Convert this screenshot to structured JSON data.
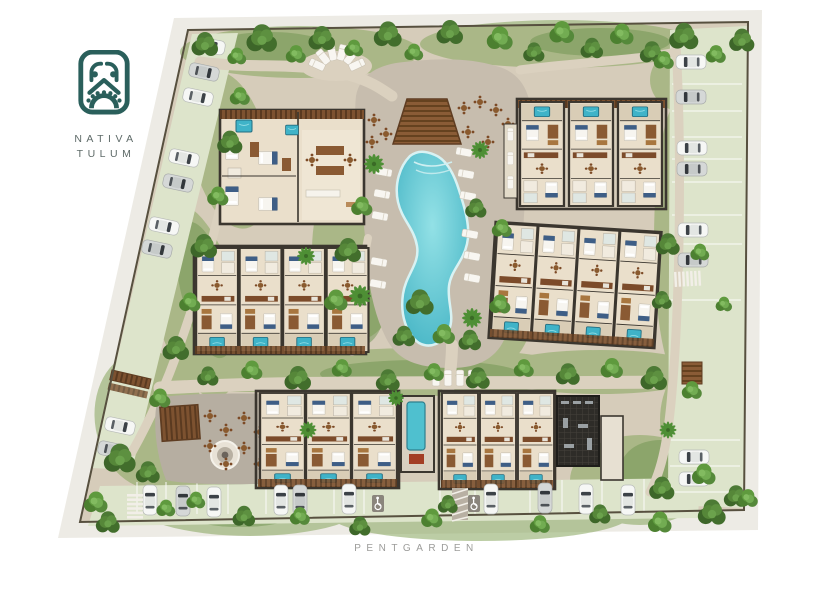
{
  "branding": {
    "logo_icon": "mayan-glyph-logo",
    "name_line1": "NATIVA",
    "name_line2": "TULUM"
  },
  "footer": {
    "project_name": "PENTGARDEN"
  },
  "site_plan": {
    "view": "top-down-masterplan-rendering",
    "amenities": [
      "main-pool",
      "pool-deck-palapa",
      "sun-loungers",
      "restaurant-plaza",
      "round-fountain",
      "lap-pool-courtyard",
      "gym-building",
      "gardens",
      "perimeter-parking",
      "accessible-parking",
      "crosswalks",
      "entrance-gates"
    ],
    "residential_buildings": 6
  },
  "colors": {
    "logo_teal": "#2a5f5b",
    "brand_text": "#5e6a68",
    "footer_text": "#9c9c9a",
    "canvas": "#ffffff",
    "sidewalk": "#edebe5",
    "lawn": "#dde4cb",
    "sand": "#dbd1bf",
    "site_base": "#d6ccba",
    "paver": "#c7bdae",
    "plaza_gray": "#b6aea1",
    "pool_water": "#58c5d0",
    "pool_edge": "#d8f2f3",
    "plunge_pool": "#3fb3c8",
    "wall": "#3b362f",
    "floor": "#eadfcb",
    "wood": "#7d5230",
    "tree_dark": "#3d6629",
    "tree_mid": "#4c7a35",
    "tree_light": "#6ba24c",
    "car_white": "#f6f7f5",
    "car_silver": "#d4d7d6",
    "terracotta": "#9c4f2c"
  }
}
